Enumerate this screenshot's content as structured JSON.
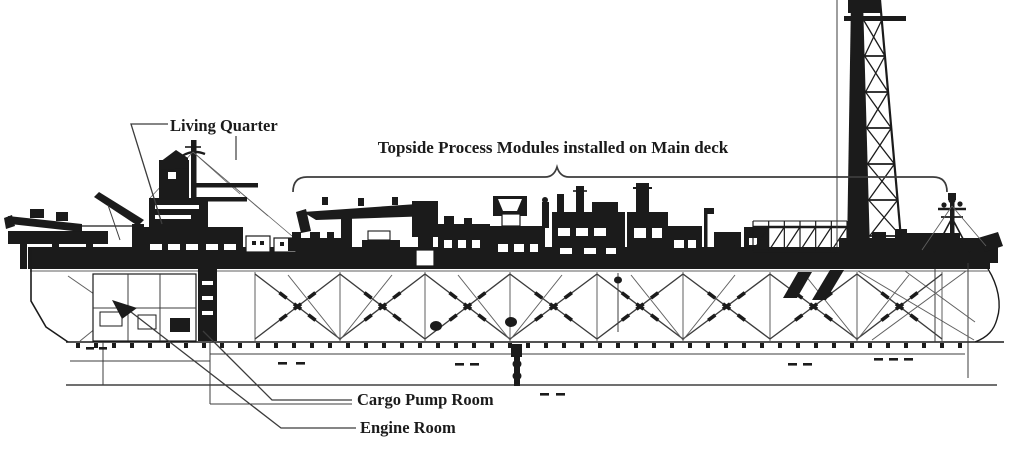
{
  "meta": {
    "title": "FPSO vessel side elevation technical drawing",
    "drawing_type": "black and white line drawing"
  },
  "colors": {
    "paper": "#ffffff",
    "ink": "#1b1b1b",
    "mid": "#3c3c3c",
    "light": "#5f5f5f"
  },
  "labels": {
    "living_quarter": "Living Quarter",
    "topside_modules": "Topside Process  Modules installed on Main deck",
    "cargo_pump_room": "Cargo Pump Room",
    "engine_room": "Engine Room"
  },
  "parts_depicted": [
    "Living Quarter superstructure with masts and crane",
    "Bow platform and boom",
    "Topside process modules on main deck",
    "Deck crane",
    "Derrick / flare tower",
    "Stern mast",
    "Hull with cross-braced tank internals",
    "Cargo Pump Room leader",
    "Engine Room leader",
    "Keel baseline"
  ]
}
